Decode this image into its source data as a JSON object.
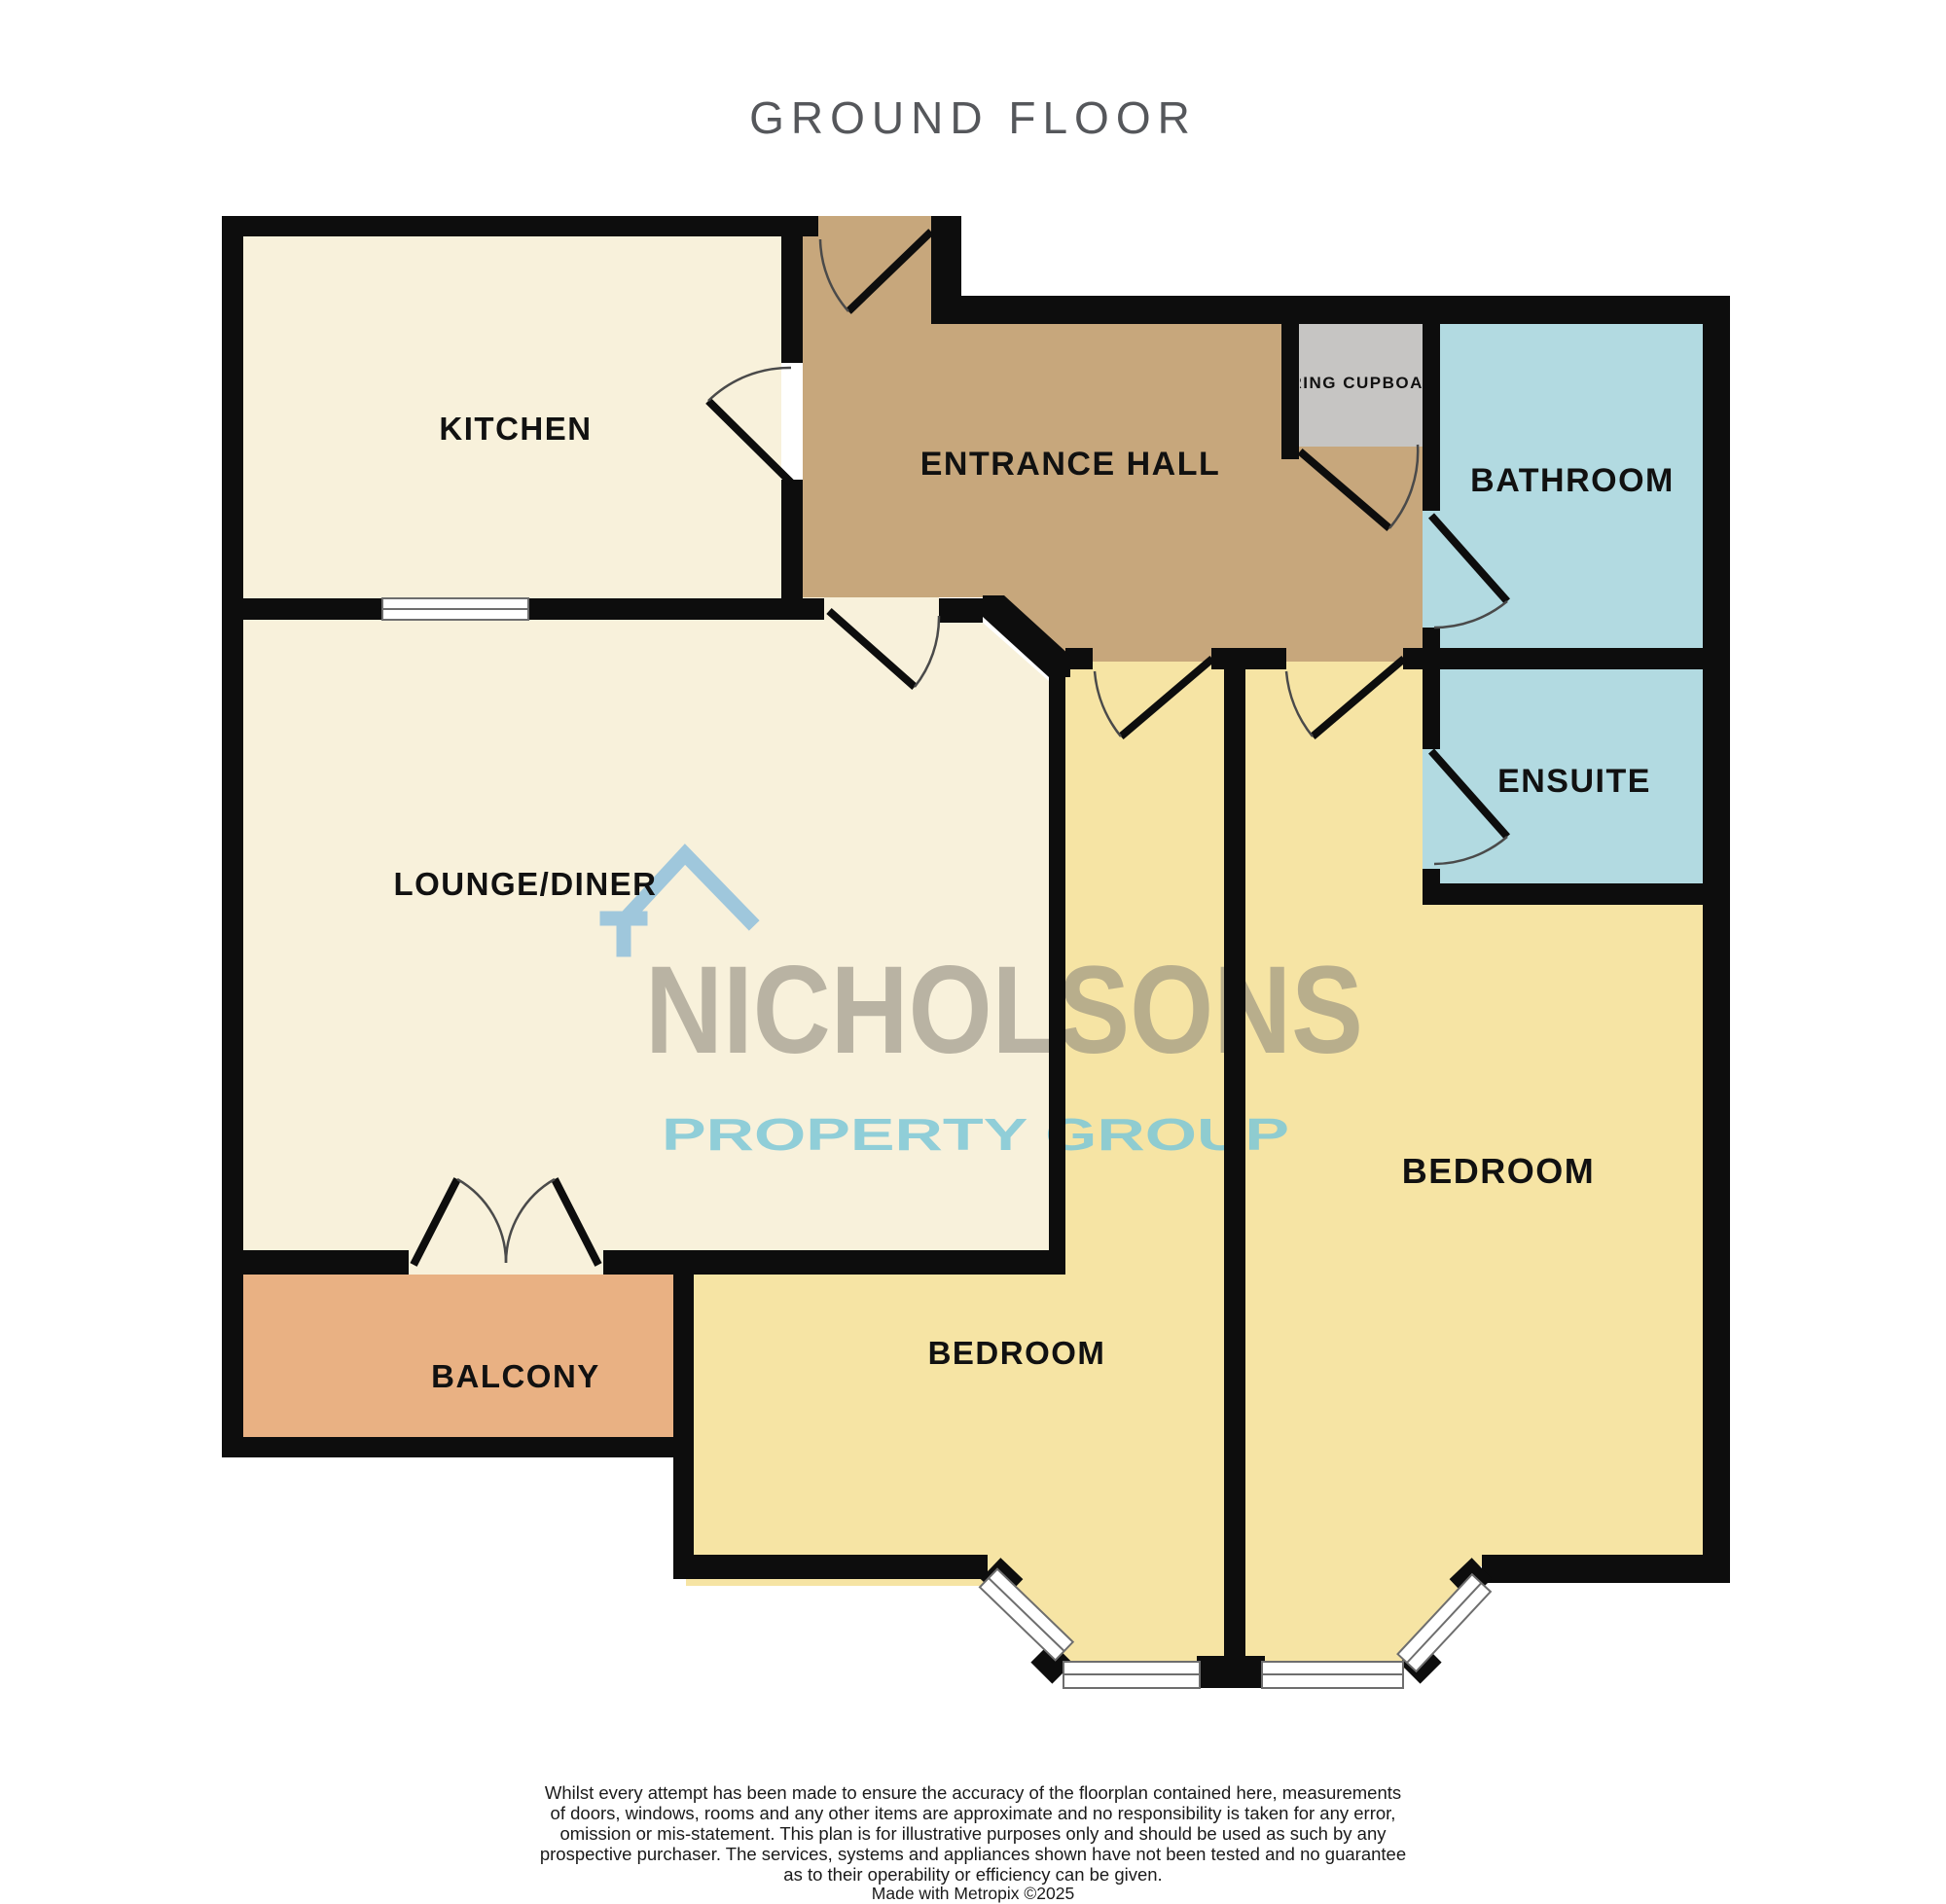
{
  "title": "GROUND FLOOR",
  "colors": {
    "cream": "#F8F1DB",
    "hall_tan": "#C7A77C",
    "cupboard_gray": "#C6C5C3",
    "bath_blue": "#B2DAE1",
    "bedroom_yellow": "#F6E4A4",
    "balcony_orange": "#E9B183",
    "wall": "#0D0D0D",
    "window_line": "#6E6E6E",
    "door_arc": "#4A4A4A",
    "title": "#55575B",
    "label": "#111111",
    "watermark_name": "#8D887C",
    "watermark_tagline": "#7EC8D8",
    "watermark_house": "#8FC0DC",
    "footer": "#1A1A1A"
  },
  "rooms": {
    "kitchen": {
      "label": "KITCHEN"
    },
    "entrance_hall": {
      "label": "ENTRANCE HALL"
    },
    "airing_cupboard": {
      "label": "AIRING CUPBOARD"
    },
    "bathroom": {
      "label": "BATHROOM"
    },
    "ensuite": {
      "label": "ENSUITE"
    },
    "lounge_diner": {
      "label": "LOUNGE/DINER"
    },
    "balcony": {
      "label": "BALCONY"
    },
    "bedroom_left": {
      "label": "BEDROOM"
    },
    "bedroom_right": {
      "label": "BEDROOM"
    }
  },
  "watermark": {
    "name": "NICHOLSONS",
    "tagline": "PROPERTY GROUP"
  },
  "footer": {
    "lines": [
      "Whilst every attempt has been made to ensure the accuracy of the floorplan contained here, measurements",
      "of doors, windows, rooms and any other items are approximate and no responsibility is taken for any error,",
      "omission or mis-statement. This plan is for illustrative purposes only and should be used as such by any",
      "prospective purchaser. The services, systems and appliances shown have not been tested and no guarantee",
      "as to their operability or efficiency can be given."
    ],
    "credit": "Made with Metropix ©2025"
  }
}
